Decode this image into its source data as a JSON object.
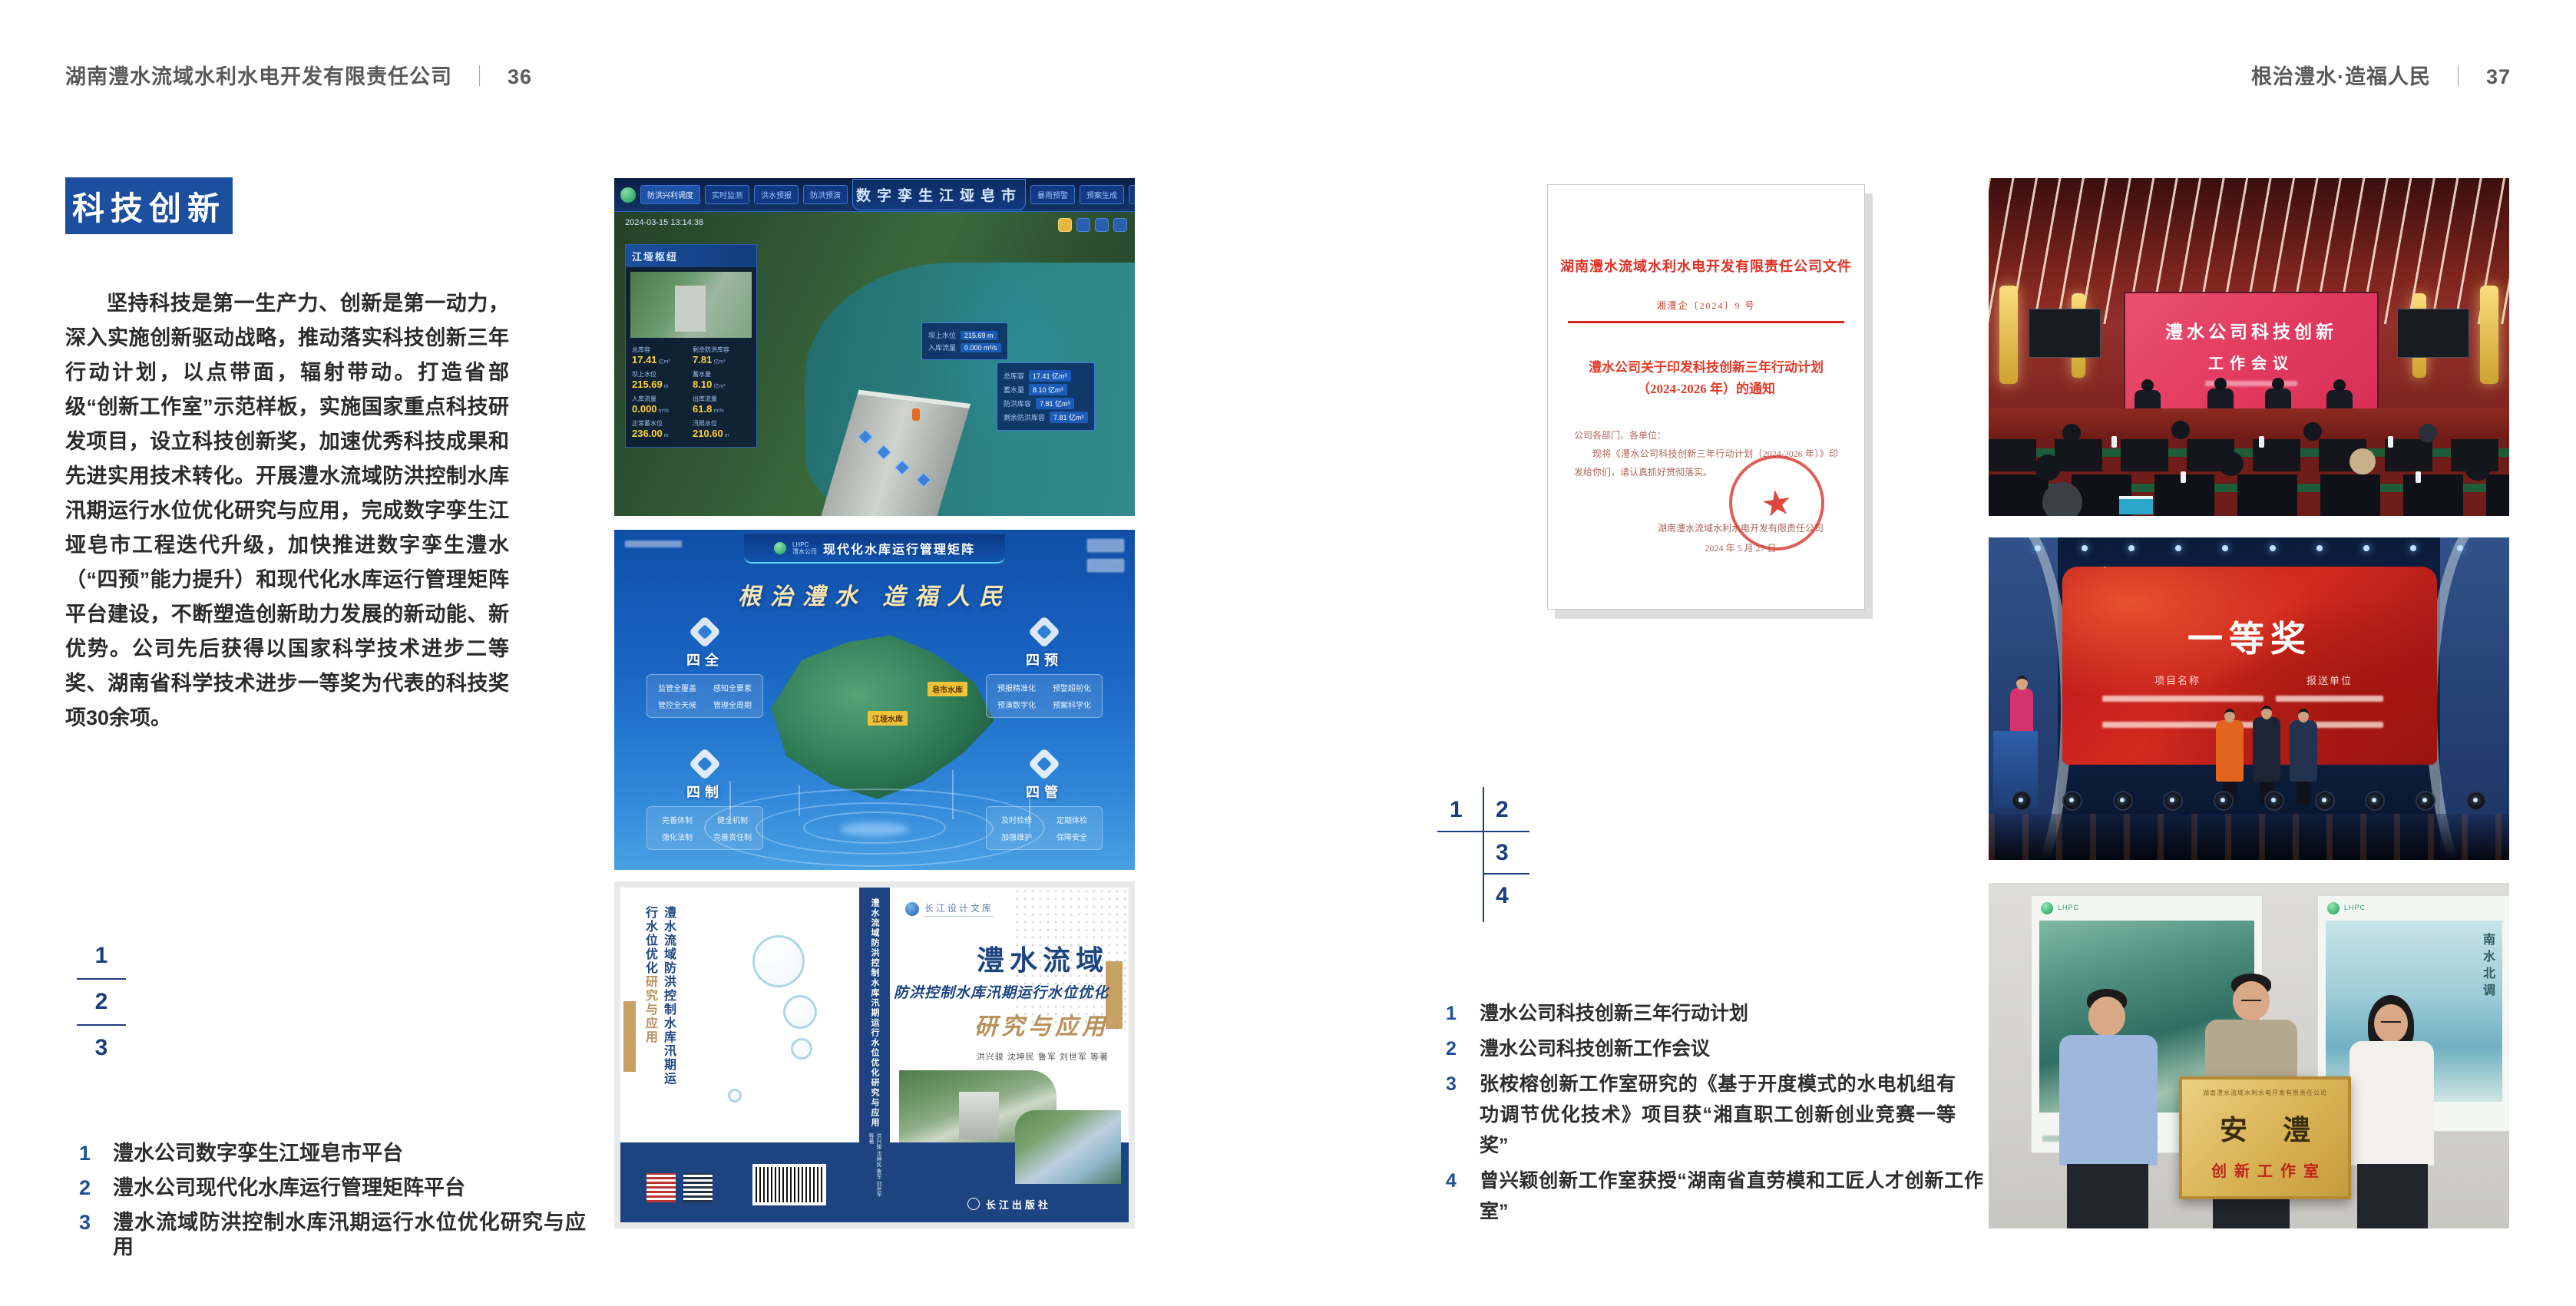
{
  "colors": {
    "accent_blue": "#1d4f9f",
    "number_blue": "#1c3e7e",
    "doc_red": "#e03024",
    "book_navy": "#1d4480",
    "gold": "#c9a063"
  },
  "left_page": {
    "header_title": "湖南澧水流域水利水电开发有限责任公司",
    "page_number": "36",
    "badge": "科技创新",
    "body": "坚持科技是第一生产力、创新是第一动力，深入实施创新驱动战略，推动落实科技创新三年行动计划，以点带面，辐射带动。打造省部级“创新工作室”示范样板，实施国家重点科技研发项目，设立科技创新奖，加速优秀科技成果和先进实用技术转化。开展澧水流域防洪控制水库汛期运行水位优化研究与应用，完成数字孪生江垭皂市工程迭代升级，加快推进数字孪生澧水（“四预”能力提升）和现代化水库运行管理矩阵平台建设，不断塑造创新助力发展的新动能、新优势。公司先后获得以国家科学技术进步二等奖、湖南省科学技术进步一等奖为代表的科技奖项30余项。",
    "figure_numbers": [
      "1",
      "2",
      "3"
    ],
    "captions": [
      {
        "num": "1",
        "text": "澧水公司数字孪生江垭皂市平台"
      },
      {
        "num": "2",
        "text": "澧水公司现代化水库运行管理矩阵平台"
      },
      {
        "num": "3",
        "text": "澧水流域防洪控制水库汛期运行水位优化研究与应用"
      }
    ]
  },
  "right_page": {
    "header_title": "根治澧水·造福人民",
    "page_number": "37",
    "figure_numbers": [
      "1",
      "2",
      "3",
      "4"
    ],
    "captions": [
      {
        "num": "1",
        "text": "澧水公司科技创新三年行动计划"
      },
      {
        "num": "2",
        "text": "澧水公司科技创新工作会议"
      },
      {
        "num": "3",
        "text": "张桉榕创新工作室研究的《基于开度模式的水电机组有功调节优化技术》项目获“湘直职工创新创业竞赛一等奖”"
      },
      {
        "num": "4",
        "text": "曾兴颖创新工作室获授“湖南省直劳模和工匠人才创新工作室”"
      }
    ]
  },
  "dashboard": {
    "title": "数字孪生江垭皂市",
    "left_module": "防洪兴利调度",
    "tabs_left": [
      "实时监测",
      "洪水预报",
      "防洪预演"
    ],
    "tabs_right": [
      "暴雨预警",
      "预案生成",
      "调度执行",
      "工程导览"
    ],
    "timestamp": "2024-03-15 13:14:38",
    "panel_title": "江垭枢纽",
    "stats": [
      {
        "label": "总库容",
        "value": "17.41",
        "unit": "亿m³"
      },
      {
        "label": "剩余防洪库容",
        "value": "7.81",
        "unit": "亿m³"
      },
      {
        "label": "坝上水位",
        "value": "215.69",
        "unit": "m"
      },
      {
        "label": "蓄水量",
        "value": "8.10",
        "unit": "亿m³"
      },
      {
        "label": "入库流量",
        "value": "0.000",
        "unit": "m³/s"
      },
      {
        "label": "出库流量",
        "value": "61.8",
        "unit": "m³/s"
      },
      {
        "label": "正常蓄水位",
        "value": "236.00",
        "unit": "m"
      },
      {
        "label": "汛限水位",
        "value": "210.60",
        "unit": "m"
      }
    ],
    "tooltip1": [
      {
        "label": "坝上水位",
        "value": "215.69 m"
      },
      {
        "label": "入库流量",
        "value": "0.000 m³/s"
      }
    ],
    "tooltip2": [
      {
        "label": "总库容",
        "value": "17.41 亿m³"
      },
      {
        "label": "蓄水量",
        "value": "8.10 亿m³"
      },
      {
        "label": "防洪库容",
        "value": "7.81 亿m³"
      },
      {
        "label": "剩余防洪库容",
        "value": "7.81 亿m³"
      }
    ]
  },
  "matrix": {
    "logo_line1": "LHPC",
    "logo_line2": "澧水公司",
    "title": "现代化水库运行管理矩阵",
    "slogan": "根治澧水 造福人民",
    "groups": [
      {
        "name": "四全",
        "items": [
          "监管全覆盖",
          "感知全要素",
          "管控全天候",
          "管理全周期"
        ]
      },
      {
        "name": "四预",
        "items": [
          "预报精准化",
          "预警超前化",
          "预演数字化",
          "预案科学化"
        ]
      },
      {
        "name": "四制",
        "items": [
          "完善体制",
          "健全机制",
          "强化法制",
          "完善责任制"
        ]
      },
      {
        "name": "四管",
        "items": [
          "及时检修",
          "定期体检",
          "加强维护",
          "保障安全"
        ]
      }
    ],
    "map_labels": [
      "皂市水库",
      "江垭水库"
    ]
  },
  "book": {
    "series": "长江设计文库",
    "title_1": "澧水流域",
    "title_2": "防洪控制水库汛期运行水位优化",
    "title_3": "研究与应用",
    "authors": "洪兴骏  沈坤民  鲁军  刘世军  等著",
    "back_title_a": "澧水流域",
    "back_title_b": "防洪控制水库汛期运行水位优化",
    "back_title_c": "研究与应用",
    "spine_text": "澧水流域防洪控制水库汛期运行水位优化研究与应用",
    "spine_authors": "洪兴骏 沈坤民 鲁军 刘世军 等著",
    "publisher": "长江出版社"
  },
  "document": {
    "head": "湖南澧水流域水利水电开发有限责任公司文件",
    "number": "湘澧企〔2024〕9 号",
    "title_line1": "澧水公司关于印发科技创新三年行动计划",
    "title_line2": "（2024-2026 年）的通知",
    "salutation": "公司各部门、各单位：",
    "body": "现将《澧水公司科技创新三年行动计划（2024-2026 年）》印发给你们，请认真抓好贯彻落实。",
    "sign_org": "湖南澧水流域水利水电开发有限责任公司",
    "sign_date": "2024 年 5 月 27 日",
    "seal_star": "★"
  },
  "meeting": {
    "screen_line1": "澧水公司科技创新",
    "screen_line2": "工作会议"
  },
  "stage": {
    "award": "一等奖",
    "col1": "项目名称",
    "col2": "报送单位"
  },
  "plaque": {
    "org": "湖南澧水流域水利水电开发有限责任公司",
    "name": "安澧",
    "sub": "创新工作室",
    "poster_right_text": "南水北调"
  }
}
